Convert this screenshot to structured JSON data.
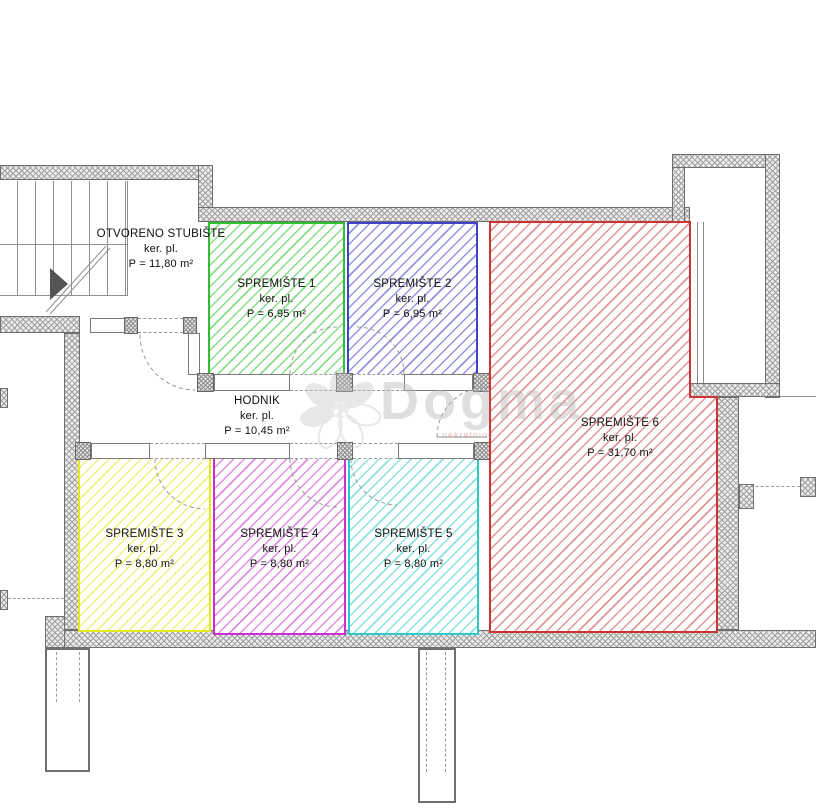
{
  "plan": {
    "rooms": [
      {
        "id": "otvoreno-stubiste",
        "name": "OTVORENO STUBIŠTE",
        "finish": "ker. pl.",
        "area": "P = 11,80 m²",
        "border": null,
        "stripe": null
      },
      {
        "id": "spremiste-1",
        "name": "SPREMIŠTE 1",
        "finish": "ker. pl.",
        "area": "P = 6,95 m²",
        "border": "#2fbf2f",
        "stripe": "#85e085"
      },
      {
        "id": "spremiste-2",
        "name": "SPREMIŠTE 2",
        "finish": "ker. pl.",
        "area": "P = 6,95 m²",
        "border": "#4242c8",
        "stripe": "#9595dd"
      },
      {
        "id": "spremiste-3",
        "name": "SPREMIŠTE 3",
        "finish": "ker. pl.",
        "area": "P = 8,80 m²",
        "border": "#e8e81e",
        "stripe": "#f0f07e"
      },
      {
        "id": "spremiste-4",
        "name": "SPREMIŠTE 4",
        "finish": "ker. pl.",
        "area": "P = 8,80 m²",
        "border": "#cc2fcc",
        "stripe": "#e08ae0"
      },
      {
        "id": "spremiste-5",
        "name": "SPREMIŠTE 5",
        "finish": "ker. pl.",
        "area": "P = 8,80 m²",
        "border": "#2fc9c9",
        "stripe": "#8ae2e2"
      },
      {
        "id": "spremiste-6",
        "name": "SPREMIŠTE 6",
        "finish": "ker. pl.",
        "area": "P = 31,70 m²",
        "border": "#cc3434",
        "stripe": "#e39494"
      },
      {
        "id": "hodnik",
        "name": "HODNIK",
        "finish": "ker. pl.",
        "area": "P = 10,45 m²",
        "border": null,
        "stripe": null
      }
    ],
    "watermark": {
      "brand": "Dogma",
      "subtext": "nekretnine"
    },
    "colors": {
      "wall_hatch": "#9f9f9f",
      "wall_edge": "#6f6f6f",
      "line": "#8f8f8f"
    }
  }
}
